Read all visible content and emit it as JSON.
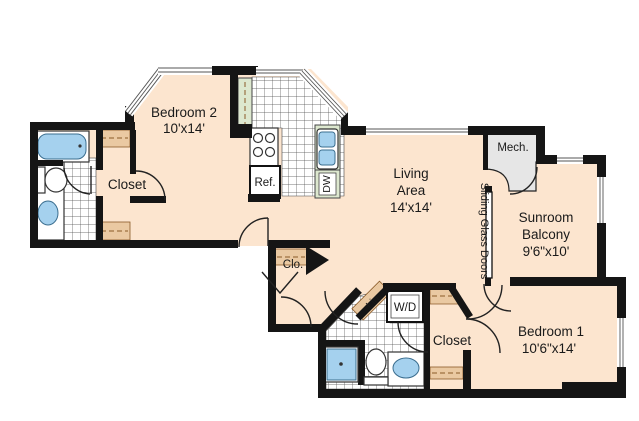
{
  "title": "Apartment floor plan",
  "colors": {
    "floor": "#fce5cf",
    "wall": "#151515",
    "counter": "#dde8cf",
    "shelf": "#eac9a2",
    "fixture": "#a5d1ee",
    "mech": "#e6e6e6",
    "text": "#1a1a1a"
  },
  "rooms": {
    "bedroom2": {
      "name": "Bedroom 2",
      "dims": "10'x14'"
    },
    "closet_left": {
      "name": "Closet"
    },
    "living": {
      "line1": "Living",
      "line2": "Area",
      "dims": "14'x14'"
    },
    "mech": {
      "name": "Mech."
    },
    "sunroom": {
      "line1": "Sunroom",
      "line2": "Balcony",
      "dims": "9'6\"x10'"
    },
    "bedroom1": {
      "name": "Bedroom 1",
      "dims": "10'6\"x14'"
    },
    "closet_bottom": {
      "name": "Closet"
    },
    "hall_closet": {
      "name": "Clo."
    },
    "linen": {
      "name": "Lin."
    }
  },
  "labels": {
    "refrigerator": "Ref.",
    "dishwasher": "DW",
    "washer_dryer": "W/D",
    "sliding_glass_doors": "Sliding Glass Doors"
  }
}
